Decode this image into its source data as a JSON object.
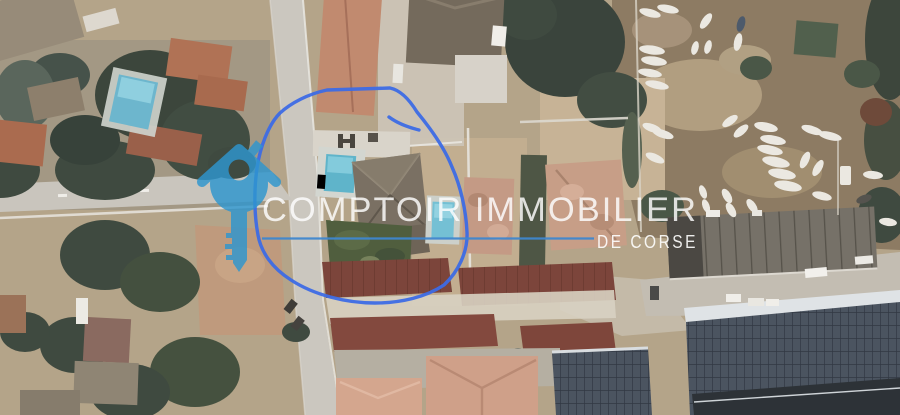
{
  "canvas": {
    "width": 900,
    "height": 415
  },
  "photo": {
    "kind": "satellite-aerial-view",
    "features": [
      "residential houses with terracotta and dark-red tile roofs",
      "vertical street and left horizontal street",
      "three swimming pools",
      "boat storage yard with many parked white boats",
      "long ribbed warehouse roof",
      "large solar-panel roof (bottom right)",
      "trees, lawns and bare dirt lots"
    ]
  },
  "watermark": {
    "brand": "COMPTOIR IMMOBILIER",
    "tagline": "DE CORSE",
    "logo": "house-key-icon",
    "colors": {
      "logo_blue": "#2e96cf",
      "text_white": "#ffffff",
      "divider_blue": "#3f87cf"
    }
  },
  "annotation": {
    "type": "freehand-outline",
    "purpose": "highlights the listed property parcel",
    "color": "#3d6ce5"
  }
}
